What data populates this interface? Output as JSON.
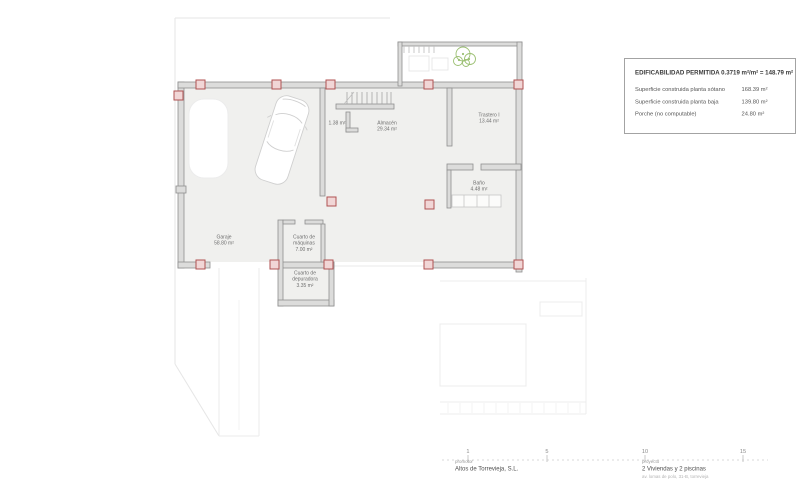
{
  "legend": {
    "title": "EDIFICABILIDAD PERMITIDA 0.3719 m²/m² = 148.79 m²",
    "rows": [
      {
        "label": "Superficie construida planta sótano",
        "value": "168.39 m²"
      },
      {
        "label": "Superficie construida planta baja",
        "value": "139.80 m²"
      },
      {
        "label": "Porche (no computable)",
        "value": "24.80 m²"
      }
    ]
  },
  "rooms": {
    "garaje": {
      "name": "Garaje",
      "area": "58.80 m²"
    },
    "almacen": {
      "name": "Almacén",
      "area": "29.34 m²"
    },
    "trastero": {
      "name": "Trastero I",
      "area": "13.44 m²"
    },
    "bano": {
      "name": "Baño",
      "area": "4.48 m²"
    },
    "maquinas": {
      "name": "Cuarto de máquinas",
      "area": "7.00 m²"
    },
    "depuradora": {
      "name": "Cuarto de depuradora",
      "area": "3.35 m²"
    },
    "hueco": {
      "area": "1.38 m²"
    }
  },
  "scalebar": {
    "ticks": [
      "1",
      "5",
      "10",
      "15"
    ]
  },
  "titleblock": {
    "promoter_label": "promotor",
    "promoter": "Altos de Torrevieja, S.L.",
    "project_label": "proyecto",
    "project": "2 Viviendas y 2 piscinas",
    "address": "av. lomas de polo, 31-B, torrevieja"
  },
  "colors": {
    "wall_fill": "#dcdcdb",
    "wall_stroke": "#8f8f8f",
    "column_fill": "#f1d6d6",
    "column_stroke": "#b05252",
    "floor_fill": "#f0f0ee",
    "plant_green": "#8ab55a"
  }
}
